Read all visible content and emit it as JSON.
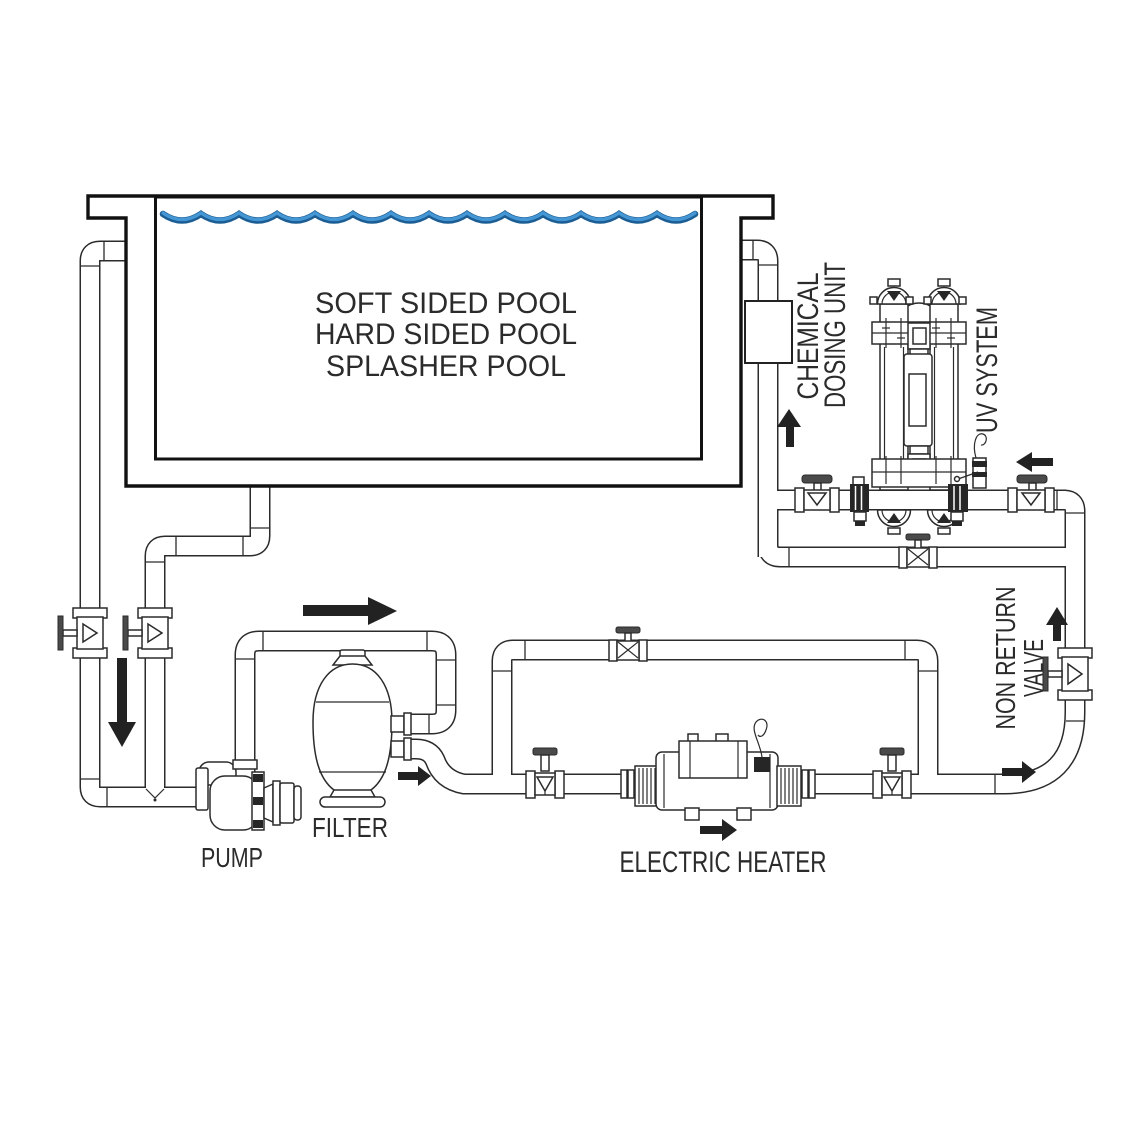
{
  "diagram": {
    "pool": {
      "label_lines": [
        "SOFT SIDED POOL",
        "HARD SIDED POOL",
        "SPLASHER POOL"
      ]
    },
    "components": {
      "pump": {
        "label": "PUMP"
      },
      "filter": {
        "label": "FILTER"
      },
      "electric_heater": {
        "label": "ELECTRIC HEATER"
      },
      "chemical_dosing_unit": {
        "label_line1": "CHEMICAL",
        "label_line2": "DOSING UNIT"
      },
      "uv_system": {
        "label": "UV SYSTEM"
      },
      "non_return_valve": {
        "label_line1": "NON RETURN",
        "label_line2": "VALVE"
      }
    },
    "colors": {
      "water_dark": "#1c5e94",
      "water_light": "#4596d4",
      "line": "#2b2b2b",
      "arrow": "#222222"
    }
  }
}
